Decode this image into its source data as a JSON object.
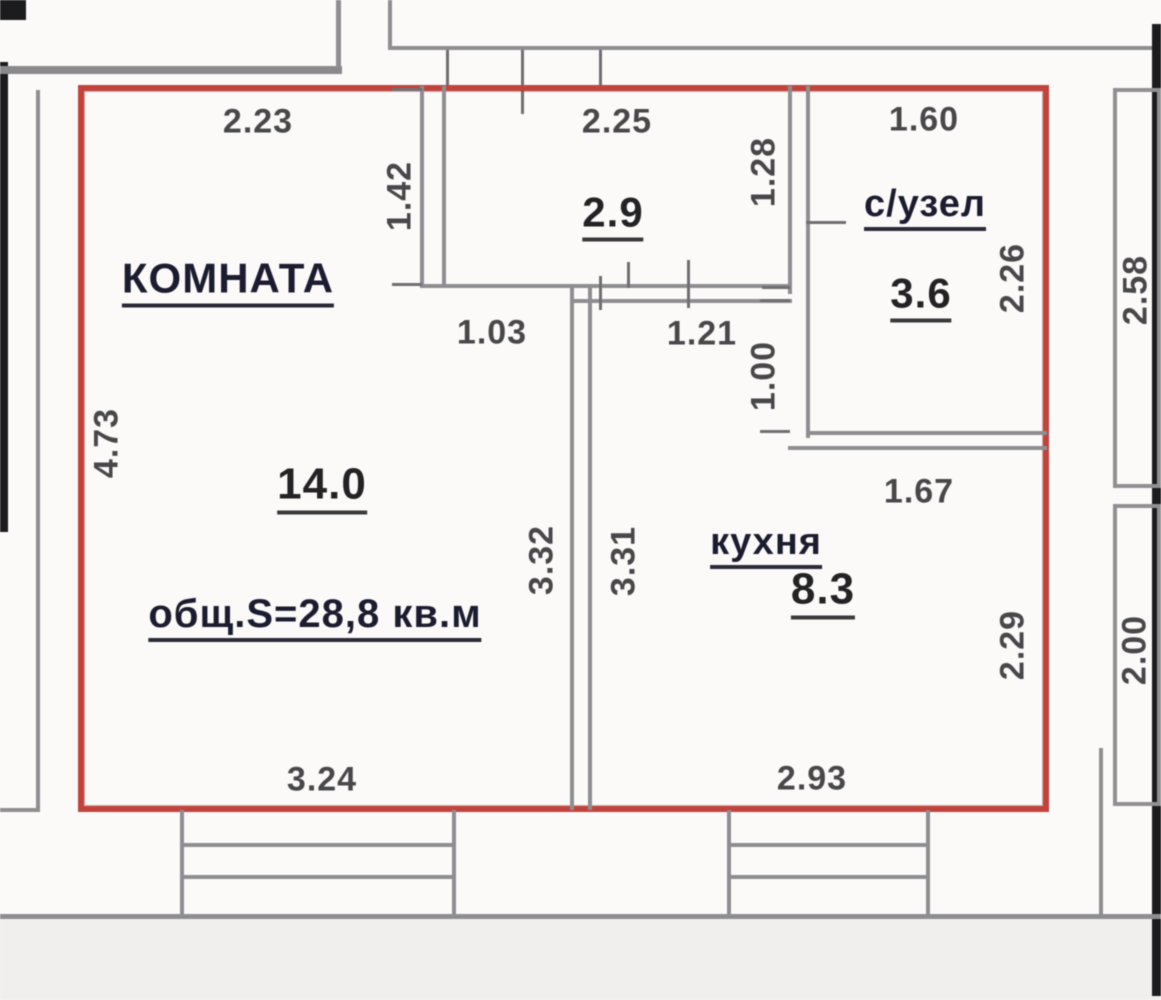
{
  "plan_title": "apartment-floor-plan",
  "rooms": {
    "room": {
      "name": "КОМНАТА",
      "area": "14.0"
    },
    "hallway": {
      "area": "2.9"
    },
    "bathroom": {
      "name": "с/узел",
      "area": "3.6"
    },
    "kitchen": {
      "name": "кухня",
      "area": "8.3"
    },
    "total_area": "общ.S=28,8 кв.м"
  },
  "dimensions": {
    "top_room": "2.23",
    "top_hall": "2.25",
    "top_bath": "1.60",
    "hall_left": "1.42",
    "bath_left": "1.28",
    "bath_inner": "2.26",
    "neighbor_right_top": "2.58",
    "room_left": "4.73",
    "door_room": "1.03",
    "door_kitchen": "1.21",
    "bath_door": "1.00",
    "bath_bottom": "1.67",
    "divider_room_side": "3.32",
    "divider_kitchen_side": "3.31",
    "kitchen_right": "2.29",
    "neighbor_right_bottom": "2.00",
    "bottom_room": "3.24",
    "bottom_kitchen": "2.93"
  },
  "colors": {
    "outline_red": "#c2423c",
    "wall_gray": "#8e8e90",
    "structure_black": "#1c1c1e",
    "dimension_text": "#48484a",
    "room_name_text": "#1c1c30"
  }
}
